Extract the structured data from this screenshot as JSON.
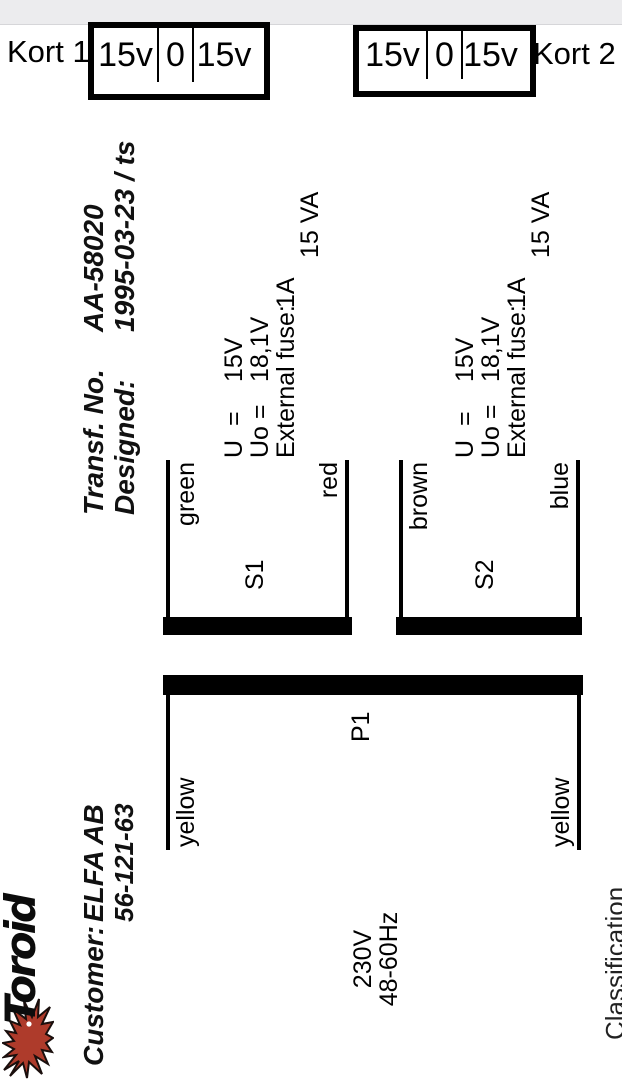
{
  "overlay": {
    "kort1_label": "Kort 1",
    "kort2_label": "Kort 2",
    "card1_cells": [
      "15v",
      "0",
      "15v"
    ],
    "card2_cells": [
      "15v",
      "0",
      "15v"
    ]
  },
  "document": {
    "logo": {
      "brand": "Toroid"
    },
    "header": {
      "customer_label": "Customer:",
      "customer_value": "ELFA AB",
      "customer_number": "56-121-63",
      "transf_no_label": "Transf. No.",
      "transf_no_value": "AA-58020",
      "designed_label": "Designed:",
      "designed_value": "1995-03-23 / ts"
    },
    "schematic": {
      "primary": {
        "name": "P1",
        "voltage": "230V",
        "frequency": "48-60Hz",
        "top_lead_color": "yellow",
        "bottom_lead_color": "yellow"
      },
      "secondaries": [
        {
          "name": "S1",
          "top_lead_color": "green",
          "bottom_lead_color": "red",
          "u_label": "U  =",
          "u_value": "15V",
          "uo_label": "Uo =",
          "uo_value": "18,1V",
          "fuse_label": "External fuse:",
          "fuse_value": "1A",
          "power": "15 VA"
        },
        {
          "name": "S2",
          "top_lead_color": "brown",
          "bottom_lead_color": "blue",
          "u_label": "U  =",
          "u_value": "15V",
          "uo_label": "Uo =",
          "uo_value": "18,1V",
          "fuse_label": "External fuse:",
          "fuse_value": "1A",
          "power": "15 VA"
        }
      ]
    },
    "footer": {
      "classification": "Classification"
    }
  },
  "colors": {
    "starburst_fill": "#ae3b2b",
    "starburst_stroke": "#1a0f0d"
  }
}
